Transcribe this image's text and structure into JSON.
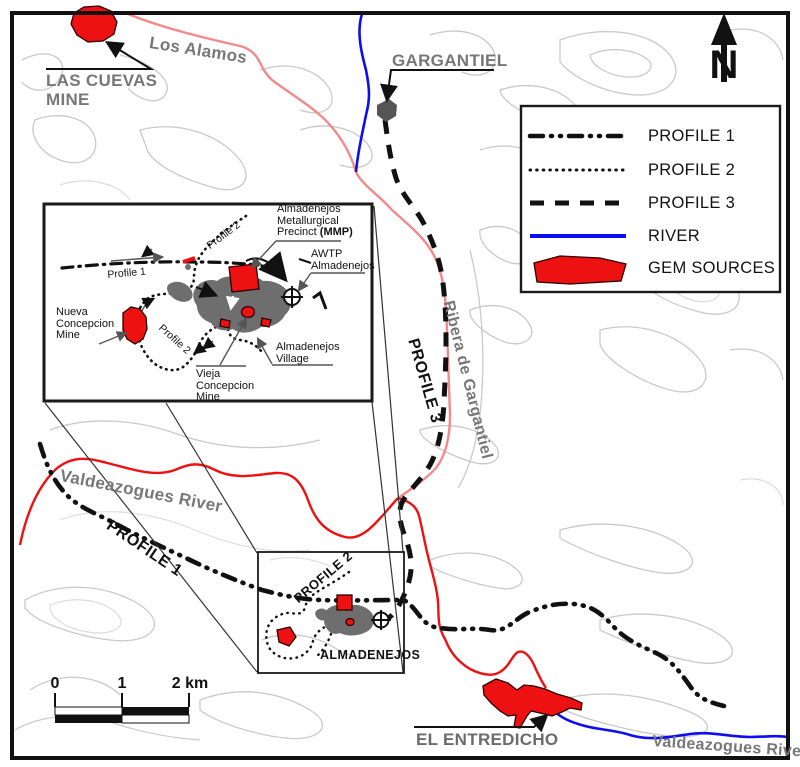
{
  "colors": {
    "profile_black": "#111111",
    "river_blue": "#0d0df0",
    "stream_pink": "#f4898b",
    "river_red": "#ee1111",
    "gem_red": "#ee1111",
    "settlement_gray": "#6e6e6e",
    "label_gray": "#777777",
    "contour_gray": "#c9c9c9"
  },
  "compass": {
    "label": "N"
  },
  "legend": {
    "items": [
      {
        "id": "profile-1",
        "label": "PROFILE 1"
      },
      {
        "id": "profile-2",
        "label": "PROFILE 2"
      },
      {
        "id": "profile-3",
        "label": "PROFILE 3"
      },
      {
        "id": "river",
        "label": "RIVER"
      },
      {
        "id": "gem-sources",
        "label": "GEM SOURCES"
      }
    ]
  },
  "scalebar": {
    "tick0": "0",
    "tick1": "1",
    "tick2": "2 km"
  },
  "map": {
    "las_cuevas": {
      "line1": "LAS CUEVAS",
      "line2": "MINE"
    },
    "los_alamos": "Los Alamos",
    "gargantiel": "GARGANTIEL",
    "ribera_de_gargantiel": "Ribera de Gargantiel",
    "profile3": "PROFILE 3",
    "valdeazogues_west": "Valdeazogues River",
    "profile1": "PROFILE 1",
    "profile2": "PROFILE 2",
    "almadenejos": "ALMADENEJOS",
    "el_entredicho": "EL ENTREDICHO",
    "valdeazogues_southeast": "Valdeazogues River"
  },
  "inset": {
    "mmp": {
      "line1": "Almadenejos",
      "line2": "Metallurgical",
      "line3a": "Precinct ",
      "line3b": "(MMP)"
    },
    "awtp": {
      "line1": "AWTP",
      "line2": "Almadenejos"
    },
    "profile1_label": "Profile 1",
    "profile2_label_top": "Profile 2",
    "profile2_label_mid": "Profile 2",
    "nueva": {
      "line1": "Nueva",
      "line2": "Concepcion",
      "line3": "Mine"
    },
    "vieja": {
      "line1": "Vieja",
      "line2": "Concepcion",
      "line3": "Mine"
    },
    "village": {
      "line1": "Almadenejos",
      "line2": "Village"
    }
  }
}
